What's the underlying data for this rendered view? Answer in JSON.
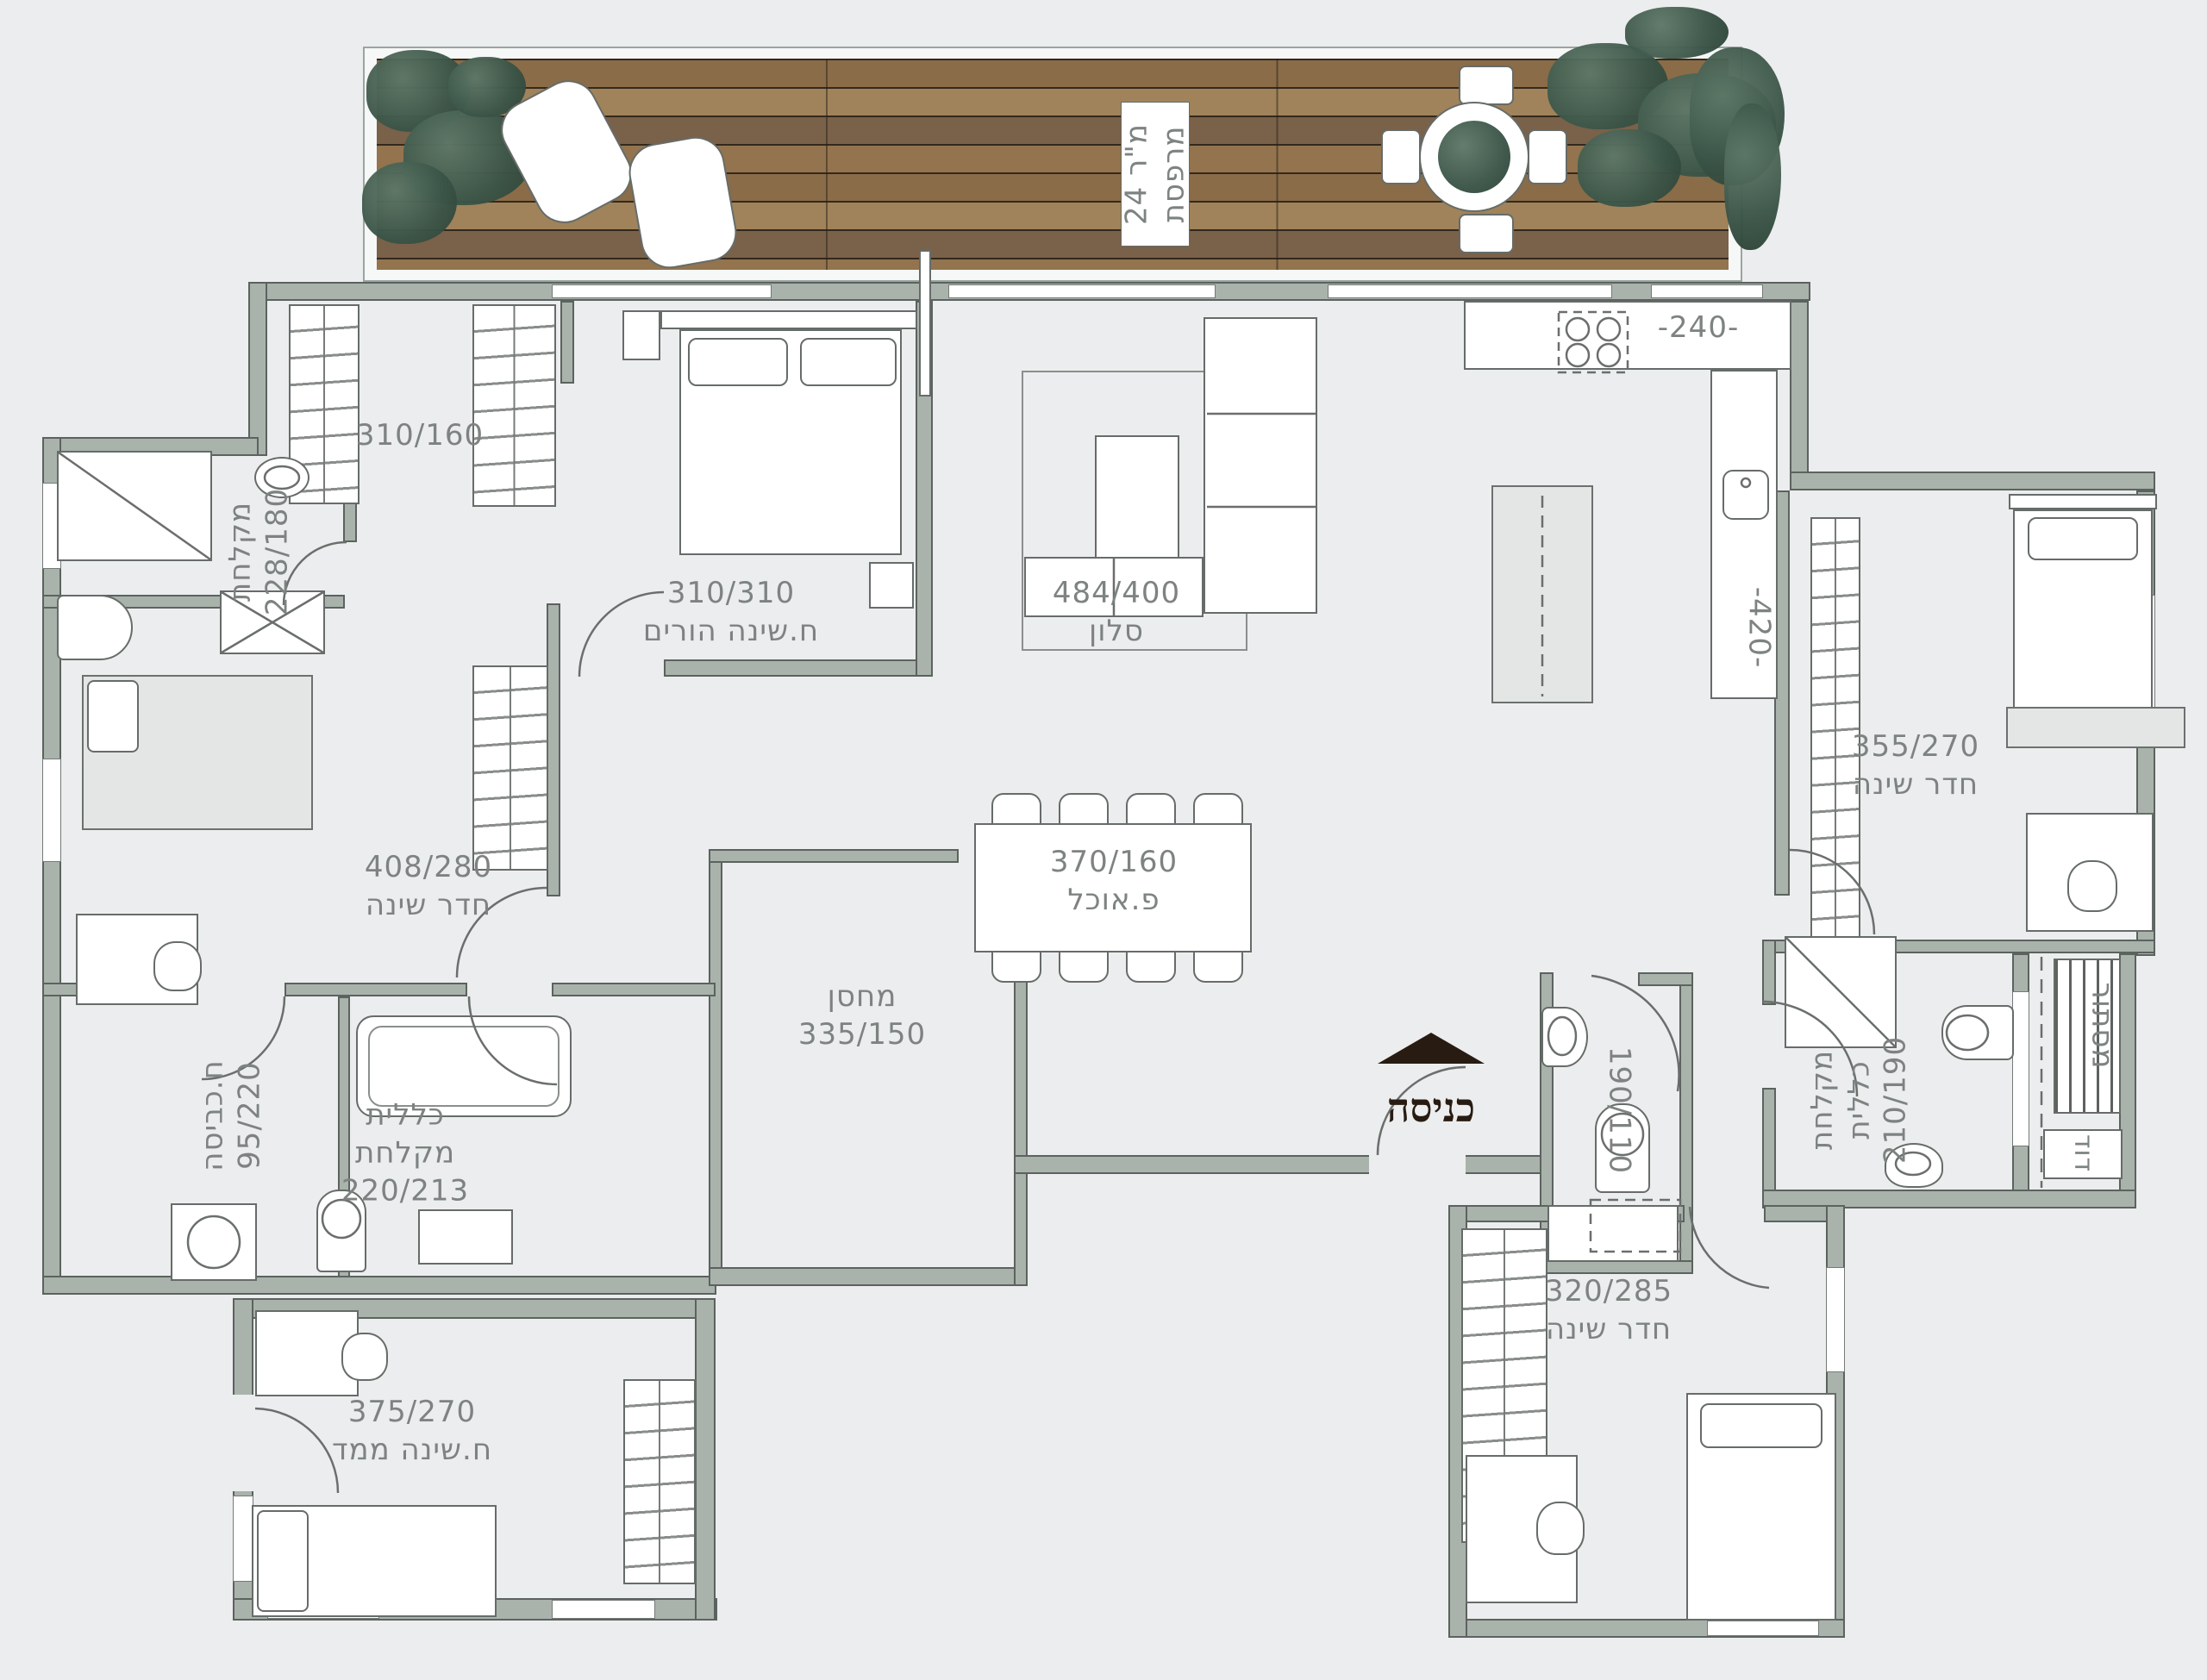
{
  "balcony": {
    "name": "מרפסת",
    "area": "24 מ\"ר"
  },
  "rooms": {
    "closets": {
      "dim": "310/160"
    },
    "bath_top": {
      "name": "מקלחת",
      "dim": "228/180"
    },
    "parents": {
      "name": "ח.שינה הורים",
      "dim": "310/310"
    },
    "living": {
      "name": "סלון",
      "dim": "484/400"
    },
    "kitchen": {
      "width_dim": "-240-",
      "length_dim": "-420-"
    },
    "bedroom_right": {
      "name": "חדר שינה",
      "dim": "355/270"
    },
    "bedroom_left": {
      "name": "חדר שינה",
      "dim": "408/280"
    },
    "dining": {
      "name": "פ.אוכל",
      "dim": "370/160"
    },
    "storage": {
      "name": "מחסן",
      "dim": "335/150"
    },
    "toilet": {
      "dim": "190/110"
    },
    "laundry": {
      "name": "ח.כביסה",
      "dim": "95/220"
    },
    "bath_general": {
      "name_line1": "כללית",
      "name_line2": "מקלחת",
      "dim": "220/213"
    },
    "bath_right": {
      "name_line1": "מקלחת",
      "name_line2": "כללית",
      "dim": "210/190"
    },
    "utility": {
      "name": "מסתור"
    },
    "boiler": {
      "name": "דוד"
    },
    "bedroom_bottom_right": {
      "name": "חדר שינה",
      "dim": "320/285"
    },
    "safe_bedroom": {
      "name": "ח.שינה ממד",
      "dim": "375/270"
    }
  },
  "entrance": {
    "label": "כניסה"
  },
  "colors": {
    "wall": "#a9b3ac",
    "background": "#ecedee",
    "deck_wood": "#93744e",
    "plant": "#3a5447",
    "entrance_mark": "#281c12",
    "label_text": "#7d8381"
  }
}
